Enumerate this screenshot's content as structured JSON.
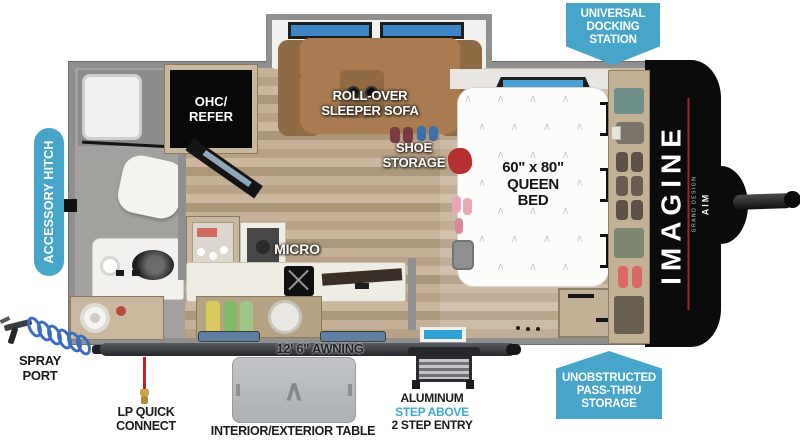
{
  "callouts": {
    "universal_docking_station": {
      "line1": "UNIVERSAL",
      "line2": "DOCKING",
      "line3": "STATION"
    },
    "unobstructed_pass_thru_storage": {
      "line1": "UNOBSTRUCTED",
      "line2": "PASS-THRU",
      "line3": "STORAGE"
    },
    "accessory_hitch": {
      "label": "ACCESSORY HITCH"
    },
    "spray_port": {
      "line1": "SPRAY",
      "line2": "PORT"
    },
    "lp_quick_connect": {
      "line1": "LP QUICK",
      "line2": "CONNECT"
    },
    "interior_exterior_table": {
      "label": "INTERIOR/EXTERIOR TABLE"
    },
    "awning": {
      "label": "12' 6\" AWNING"
    },
    "entry_steps": {
      "line1": "ALUMINUM",
      "line2": "STEP ABOVE",
      "line3": "2 STEP ENTRY"
    }
  },
  "floorplan_labels": {
    "ohc_refer": {
      "line1": "OHC/",
      "line2": "REFER"
    },
    "rollover_sofa": {
      "line1": "ROLL-OVER",
      "line2": "SLEEPER SOFA"
    },
    "shoe_storage": {
      "line1": "SHOE",
      "line2": "STORAGE"
    },
    "micro": {
      "label": "MICRO"
    },
    "queen_bed": {
      "line1": "60\" x 80\"",
      "line2": "QUEEN",
      "line3": "BED"
    }
  },
  "branding": {
    "model": "IMAGINE",
    "maker": "GRAND DESIGN",
    "trim": "AIM"
  },
  "colors": {
    "callout_teal": "#46a5c8",
    "step_above_teal": "#3fa9c9",
    "brand_accent_red": "#9c2730",
    "lp_line_red": "#c32127",
    "hose_blue": "#3a6cc0",
    "window_blue": "#3d85c6"
  },
  "decor": {
    "bed_pattern_row_a": "∧        ∧        ∧        ∧",
    "bed_pattern_row_b": "∧        ∧        ∧        ∧",
    "table_logo": "∧"
  }
}
